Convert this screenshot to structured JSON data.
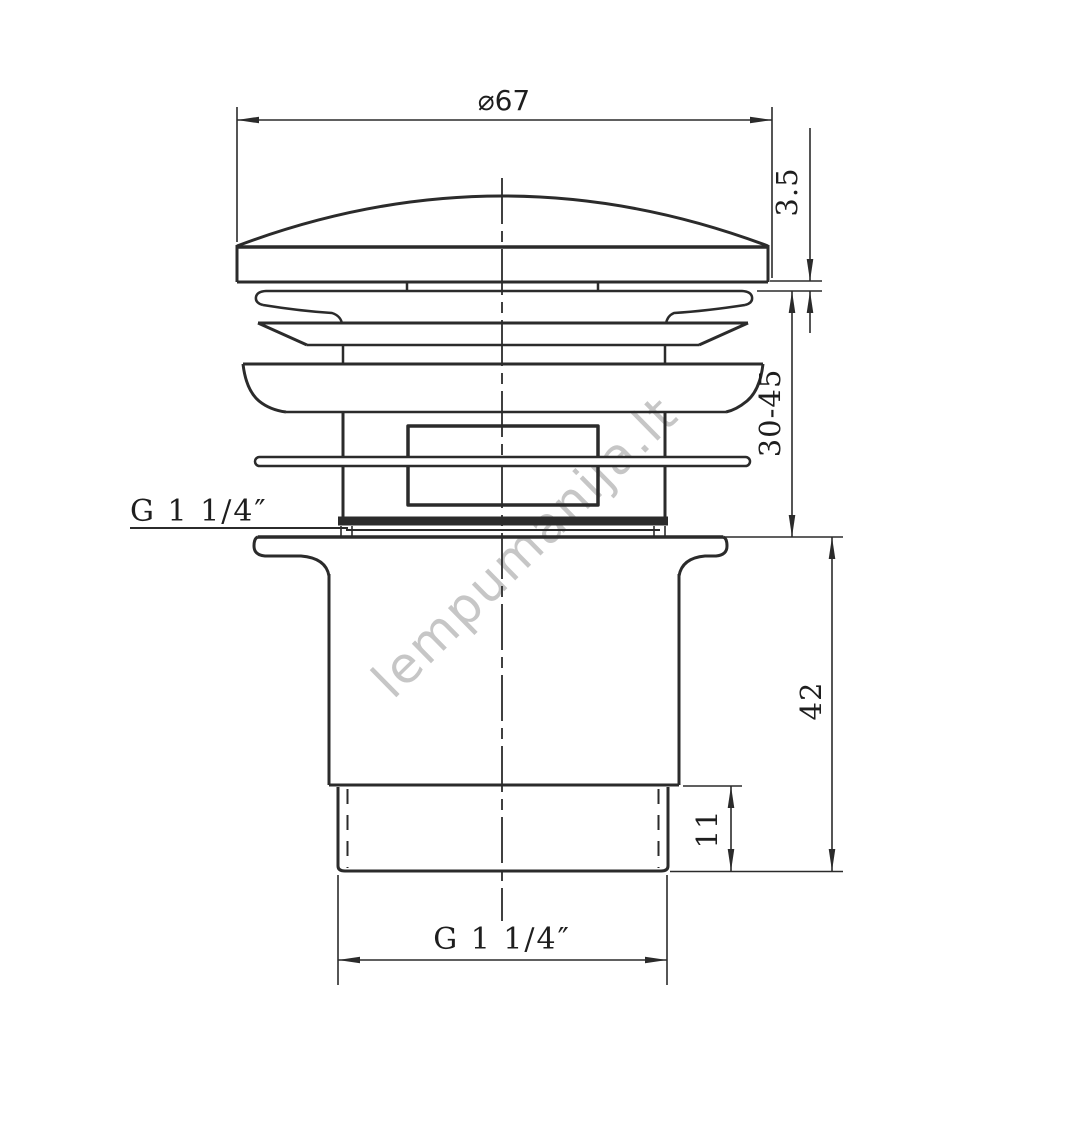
{
  "page": {
    "background": "#ffffff",
    "line_color": "#2b2b2b",
    "watermark": {
      "text": "lempumanija.lt",
      "color": "#c6c6c6"
    }
  },
  "drawing": {
    "labels": {
      "diameter_top": "⌀67",
      "cap_lip_height": "3.5",
      "clamping_range": "30-45",
      "thread_size_side": "G 1 1/4″",
      "housing_height": "42",
      "thread_length": "11",
      "thread_size_bottom": "G 1 1/4″"
    }
  }
}
